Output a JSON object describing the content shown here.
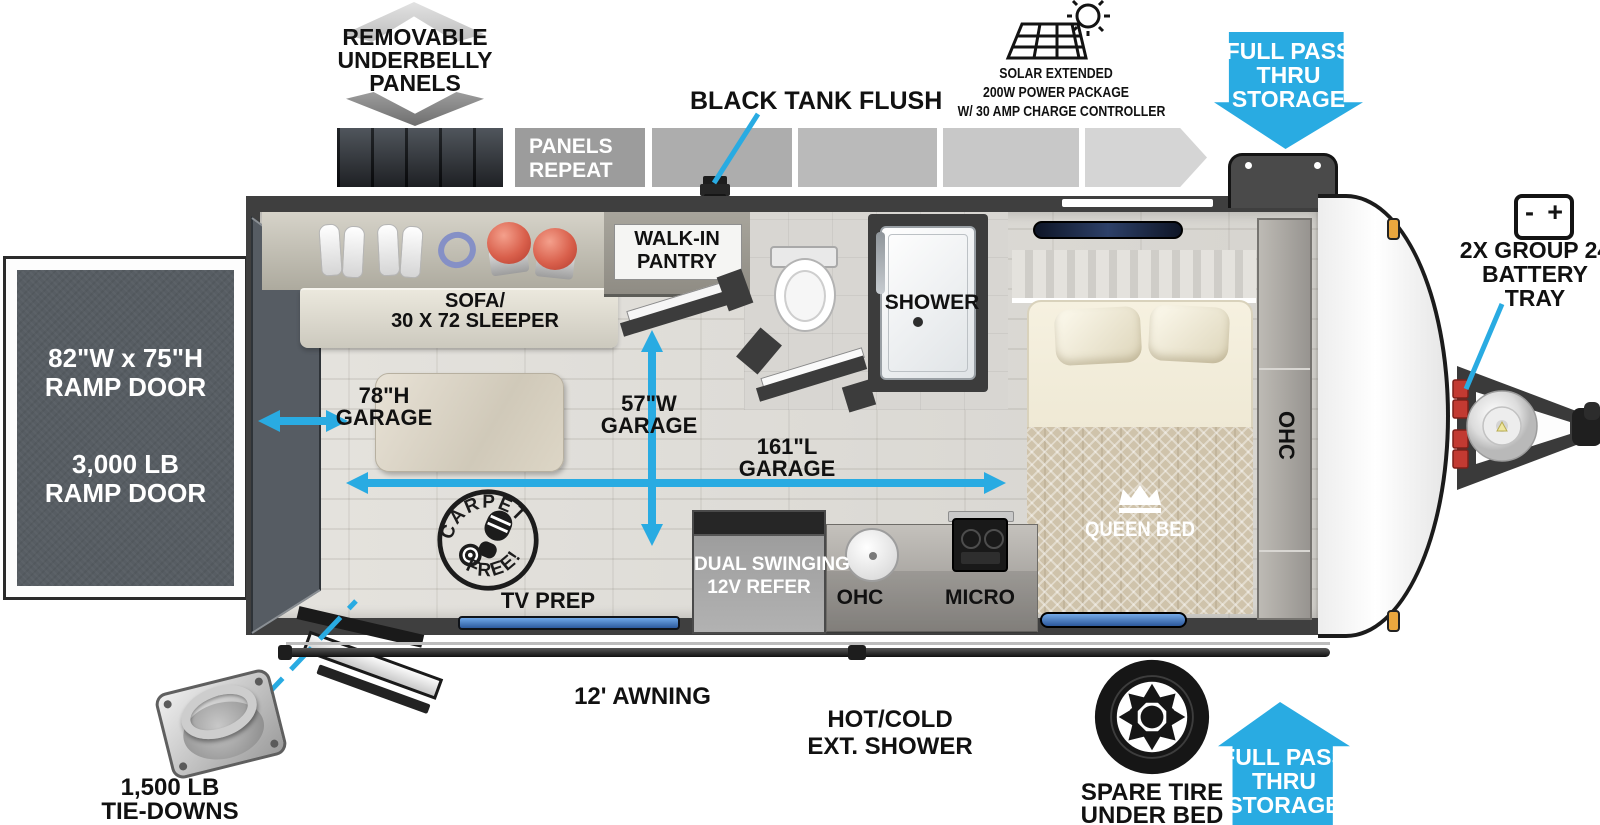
{
  "colors": {
    "accent": "#29ABE2",
    "wall": "#3f3f3f",
    "ramp_panel": "#575d63"
  },
  "top": {
    "underbelly": [
      "REMOVABLE",
      "UNDERBELLY",
      "PANELS"
    ],
    "panels_repeat": [
      "PANELS",
      "REPEAT"
    ],
    "black_tank_flush": "BLACK TANK FLUSH",
    "solar": [
      "SOLAR EXTENDED",
      "200W POWER PACKAGE",
      "W/ 30 AMP CHARGE CONTROLLER"
    ],
    "pass_thru": [
      "FULL PASS",
      "THRU",
      "STORAGE"
    ],
    "battery_minus": "-",
    "battery_plus": "+",
    "battery_label": [
      "2X GROUP 24",
      "BATTERY",
      "TRAY"
    ]
  },
  "ramp_door": {
    "size": [
      "82\"W x 75\"H",
      "RAMP DOOR"
    ],
    "capacity": [
      "3,000 LB",
      "RAMP DOOR"
    ]
  },
  "interior": {
    "sofa": [
      "SOFA/",
      "30 X 72 SLEEPER"
    ],
    "pantry": [
      "WALK-IN",
      "PANTRY"
    ],
    "shower": "SHOWER",
    "queen_bed": "QUEEN BED",
    "ohc_wardrobe": "OHC",
    "tv_prep": "TV PREP",
    "carpet_free": [
      "CARPET",
      "FREE!"
    ],
    "kitchen": {
      "refer": [
        "DUAL SWINGING",
        "12V REFER"
      ],
      "ohc": "OHC",
      "micro": "MICRO"
    }
  },
  "dimensions": {
    "height": [
      "78\"H",
      "GARAGE"
    ],
    "width": [
      "57\"W",
      "GARAGE"
    ],
    "length": [
      "161\"L",
      "GARAGE"
    ]
  },
  "bottom": {
    "tie_downs": [
      "1,500 LB",
      "TIE-DOWNS"
    ],
    "awning": "12' AWNING",
    "ext_shower": [
      "HOT/COLD",
      "EXT. SHOWER"
    ],
    "spare_tire": [
      "SPARE TIRE",
      "UNDER BED"
    ],
    "pass_thru": [
      "FULL PASS",
      "THRU",
      "STORAGE"
    ]
  }
}
